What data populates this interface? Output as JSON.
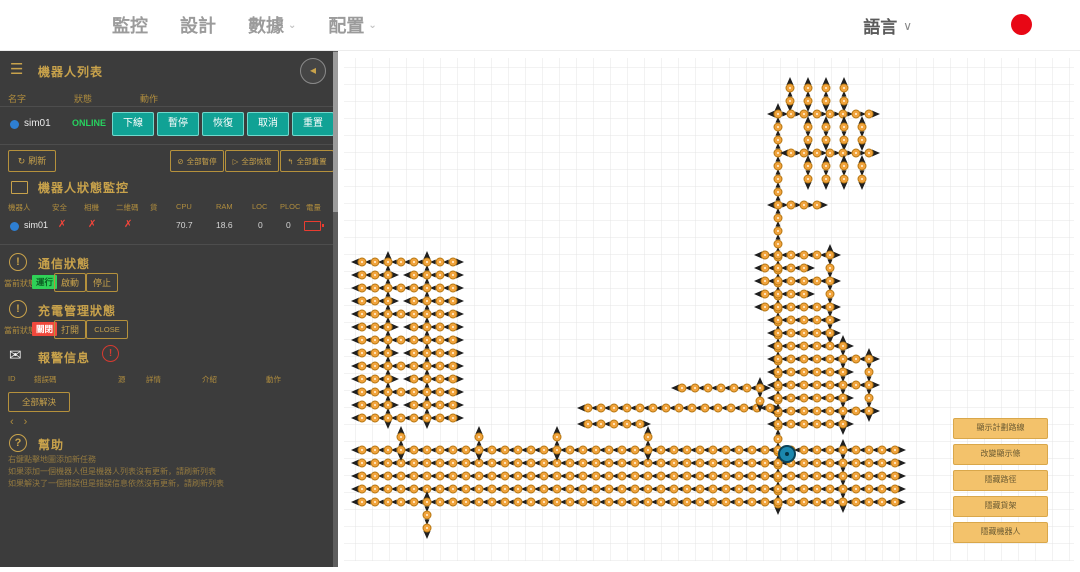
{
  "topbar": {
    "nav": [
      {
        "label": "監控",
        "caret": false
      },
      {
        "label": "設計",
        "caret": false
      },
      {
        "label": "數據",
        "caret": true
      },
      {
        "label": "配置",
        "caret": true
      }
    ],
    "language": "語言",
    "record_color": "#e80715"
  },
  "sidebar": {
    "robot_list": {
      "title": "機器人列表",
      "columns": [
        "名字",
        "狀態",
        "動作"
      ],
      "robot": {
        "name": "sim01",
        "status": "ONLINE"
      },
      "actions": [
        "下線",
        "暫停",
        "恢復",
        "取消",
        "重置"
      ],
      "refresh_label": "刷新",
      "bulk_actions": [
        {
          "icon": "⊘",
          "label": "全部暫停"
        },
        {
          "icon": "▷",
          "label": "全部恢復"
        },
        {
          "icon": "↰",
          "label": "全部重置"
        }
      ]
    },
    "status_monitor": {
      "title": "機器人狀態監控",
      "columns": [
        "機器人",
        "安全",
        "相機",
        "二維碼",
        "貨",
        "CPU",
        "RAM",
        "LOC",
        "PLOC",
        "電量"
      ],
      "row": {
        "robot": "sim01",
        "safety": "✗",
        "camera": "✗",
        "qr": "✗",
        "cpu": "70.7",
        "ram": "18.6",
        "loc": "0",
        "ploc": "0"
      }
    },
    "comm": {
      "title": "通信狀態",
      "state_label": "當前狀態",
      "state": "運行",
      "buttons": [
        "啟動",
        "停止"
      ]
    },
    "charge": {
      "title": "充電管理狀態",
      "state_label": "當前狀態",
      "state": "關閉",
      "buttons": [
        "打開",
        "CLOSE"
      ]
    },
    "alarm": {
      "title": "報警信息",
      "badge": "!",
      "columns": [
        "ID",
        "錯誤碼",
        "源",
        "詳情",
        "介紹",
        "動作"
      ],
      "resolve_all": "全部解決",
      "pager_prev": "‹",
      "pager_next": "›"
    },
    "help": {
      "title": "幫助",
      "lines": [
        "右鍵點擊地圖添加新任務",
        "如果添加一個機器人但是機器人列表沒有更新，請刷新列表",
        "如果解決了一個錯誤但是錯誤信息依然沒有更新，請刷新列表"
      ]
    }
  },
  "map": {
    "overlay_buttons": [
      "顯示計劃路線",
      "改變顯示條",
      "隱藏路徑",
      "隱藏貨架",
      "隱藏機器人"
    ],
    "colors": {
      "grid": "#e4e4e4",
      "edge": "#aeaeae",
      "arrow": "#1f1f1f",
      "node": "#f1a33c",
      "node_stroke": "#b67712",
      "robot": "#1b87ae",
      "robot_stroke": "#0b4157"
    },
    "spacing": 13,
    "robot": {
      "name": "sim01",
      "x": 449,
      "y": 404,
      "r": 8
    },
    "segments": [
      [
        "v",
        452,
        38,
        2,
        "up"
      ],
      [
        "v",
        470,
        38,
        2,
        "up"
      ],
      [
        "v",
        488,
        38,
        2,
        "up"
      ],
      [
        "v",
        506,
        38,
        2,
        "up"
      ],
      [
        "h",
        440,
        64,
        8,
        "right"
      ],
      [
        "v",
        440,
        64,
        31,
        "up"
      ],
      [
        "v",
        470,
        77,
        2,
        "down"
      ],
      [
        "v",
        488,
        77,
        2,
        "down"
      ],
      [
        "v",
        506,
        77,
        2,
        "down"
      ],
      [
        "v",
        524,
        77,
        2,
        "down"
      ],
      [
        "h",
        453,
        103,
        7,
        "right"
      ],
      [
        "v",
        470,
        116,
        2,
        "down"
      ],
      [
        "v",
        488,
        116,
        2,
        "down"
      ],
      [
        "v",
        506,
        116,
        2,
        "down"
      ],
      [
        "v",
        524,
        116,
        2,
        "down"
      ],
      [
        "h",
        440,
        155,
        4,
        "right"
      ],
      [
        "h",
        427,
        205,
        6,
        "left"
      ],
      [
        "h",
        427,
        218,
        4,
        "left"
      ],
      [
        "h",
        427,
        231,
        6,
        "left"
      ],
      [
        "h",
        427,
        244,
        4,
        "left"
      ],
      [
        "h",
        427,
        257,
        6,
        "left"
      ],
      [
        "h",
        440,
        270,
        5,
        "left"
      ],
      [
        "h",
        440,
        283,
        5,
        "left"
      ],
      [
        "v",
        492,
        205,
        7,
        "down"
      ],
      [
        "h",
        440,
        296,
        6,
        "left"
      ],
      [
        "h",
        440,
        309,
        8,
        "left"
      ],
      [
        "h",
        440,
        322,
        6,
        "left"
      ],
      [
        "h",
        440,
        335,
        8,
        "left"
      ],
      [
        "h",
        440,
        348,
        6,
        "left"
      ],
      [
        "h",
        440,
        361,
        8,
        "left"
      ],
      [
        "h",
        440,
        374,
        6,
        "left"
      ],
      [
        "v",
        505,
        296,
        7,
        "down"
      ],
      [
        "v",
        531,
        309,
        5,
        "down"
      ],
      [
        "h",
        24,
        212,
        8,
        "left"
      ],
      [
        "h",
        24,
        238,
        8,
        "left"
      ],
      [
        "h",
        24,
        264,
        8,
        "left"
      ],
      [
        "h",
        24,
        290,
        8,
        "left"
      ],
      [
        "h",
        24,
        316,
        8,
        "left"
      ],
      [
        "h",
        24,
        342,
        8,
        "left"
      ],
      [
        "h",
        24,
        368,
        8,
        "left"
      ],
      [
        "h",
        24,
        225,
        3,
        "left"
      ],
      [
        "h",
        76,
        225,
        4,
        "left"
      ],
      [
        "h",
        24,
        251,
        3,
        "left"
      ],
      [
        "h",
        76,
        251,
        4,
        "left"
      ],
      [
        "h",
        24,
        277,
        3,
        "left"
      ],
      [
        "h",
        76,
        277,
        4,
        "left"
      ],
      [
        "h",
        24,
        303,
        3,
        "left"
      ],
      [
        "h",
        76,
        303,
        4,
        "left"
      ],
      [
        "h",
        24,
        329,
        3,
        "left"
      ],
      [
        "h",
        76,
        329,
        4,
        "left"
      ],
      [
        "h",
        24,
        355,
        3,
        "left"
      ],
      [
        "h",
        76,
        355,
        4,
        "left"
      ],
      [
        "v",
        50,
        212,
        13,
        "up"
      ],
      [
        "v",
        89,
        212,
        13,
        "up"
      ],
      [
        "h",
        344,
        338,
        7,
        "left"
      ],
      [
        "h",
        250,
        358,
        15,
        "left"
      ],
      [
        "h",
        250,
        374,
        5,
        "left"
      ],
      [
        "v",
        422,
        338,
        2,
        "down"
      ],
      [
        "h",
        24,
        400,
        42,
        "left"
      ],
      [
        "h",
        24,
        413,
        42,
        "left"
      ],
      [
        "h",
        24,
        426,
        42,
        "left"
      ],
      [
        "h",
        24,
        439,
        42,
        "left"
      ],
      [
        "h",
        24,
        452,
        42,
        "left"
      ],
      [
        "v",
        63,
        387,
        2,
        "up"
      ],
      [
        "v",
        141,
        387,
        2,
        "up"
      ],
      [
        "v",
        219,
        387,
        2,
        "up"
      ],
      [
        "v",
        310,
        387,
        2,
        "up"
      ],
      [
        "v",
        89,
        452,
        3,
        "down"
      ],
      [
        "v",
        505,
        400,
        5,
        "down"
      ]
    ]
  }
}
